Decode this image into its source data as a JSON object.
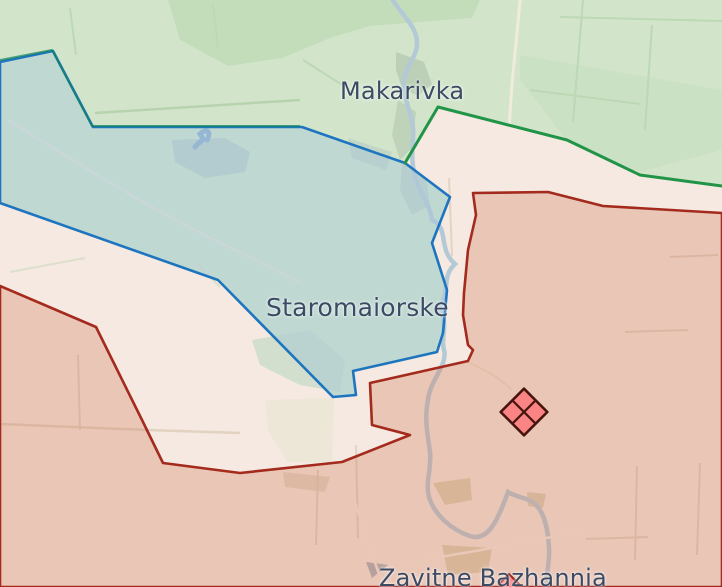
{
  "map": {
    "labels": {
      "settlement_north": "Makarivka",
      "settlement_center": "Staromaiorske",
      "settlement_south": "Zavitne Bazhannia"
    },
    "markers": {
      "fortification_icon": "fortified-area-diamond-icon",
      "settlement_icon": "settlement-diamond-icon"
    },
    "colors": {
      "terrain_green": "#d2e5cb",
      "grey_zone": "#f5e9e1",
      "liberated_fill": "#a9c8dc",
      "liberated_border": "#1e75bf",
      "frontline_green": "#219447",
      "occupied_fill": "#cf7d5e",
      "occupied_border": "#a32a1c",
      "marker_fill": "#fa8383",
      "marker_border": "#46150f",
      "river": "#b4c9d6",
      "label_text": "#3c4b63"
    }
  }
}
